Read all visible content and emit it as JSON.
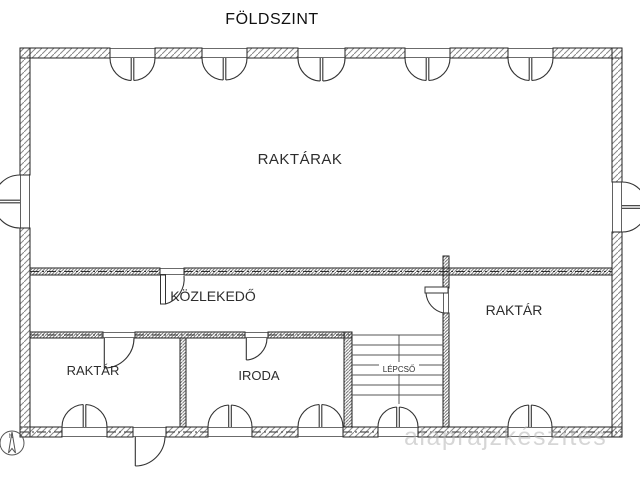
{
  "plan": {
    "title": "FÖLDSZINT",
    "rooms": {
      "raktarak": {
        "label": "RAKTÁRAK"
      },
      "kozlekedo": {
        "label": "KÖZLEKEDŐ"
      },
      "raktar_left": {
        "label": "RAKTÁR"
      },
      "iroda": {
        "label": "IRODA"
      },
      "lepcso": {
        "label": "LÉPCSŐ"
      },
      "raktar_right": {
        "label": "RAKTÁR"
      }
    },
    "north_label": "N",
    "watermark": "alaprajzkészítés",
    "colors": {
      "line": "#2b2b2b",
      "hatch_outer": "#888888",
      "hatch_inner": "#666666",
      "background": "#ffffff",
      "watermark": "#b5b5b5"
    }
  }
}
